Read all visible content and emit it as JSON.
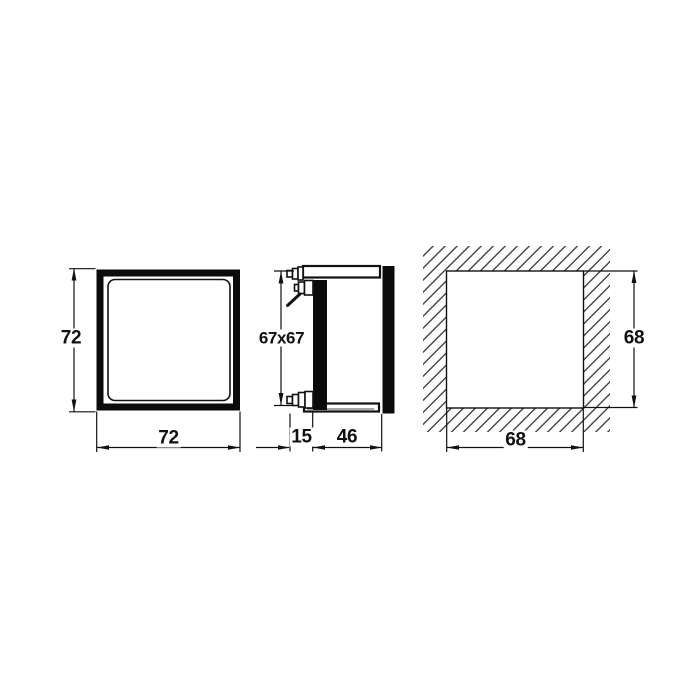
{
  "drawing_type": "technical-dimension-drawing",
  "views": {
    "front": {
      "description": "front face of square bezel frame",
      "height_mm": "72",
      "width_mm": "72"
    },
    "side": {
      "description": "side profile with mounting clamp screws",
      "body_mm": "67x67",
      "front_depth_mm": "15",
      "rear_depth_mm": "46"
    },
    "cutout": {
      "description": "hatched panel wall with square cutout",
      "height_mm": "68",
      "width_mm": "68"
    }
  },
  "colors": {
    "line": "#111111",
    "solid_fill": "#0b0b0b",
    "background": "#ffffff"
  }
}
